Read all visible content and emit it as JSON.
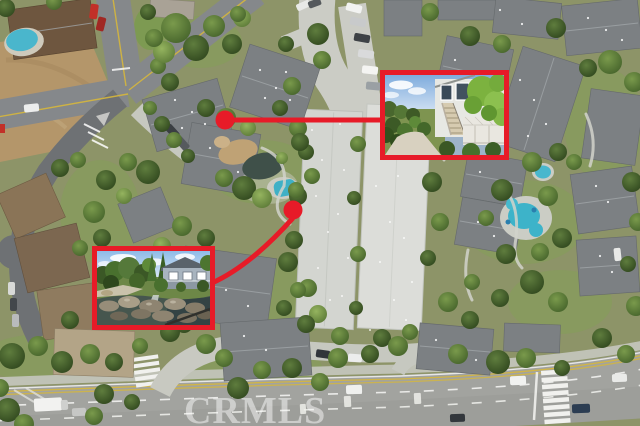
{
  "watermark": {
    "text": "CRMLS"
  },
  "callouts": {
    "color": "#e71b28",
    "items": [
      {
        "name": "upper",
        "marker": "dot",
        "connector": "straight-line",
        "target": "inset-photo-upper"
      },
      {
        "name": "lower",
        "marker": "dot",
        "connector": "curved-line",
        "target": "inset-photo-lower"
      }
    ]
  },
  "palette": {
    "annotation_red": "#e71b28",
    "pool_water": "#3fb3c9",
    "roof_gray": "#7c8083",
    "road_asphalt": "#a2a39f",
    "tree_green": "#44622a",
    "dirt_tan": "#b4966a"
  }
}
